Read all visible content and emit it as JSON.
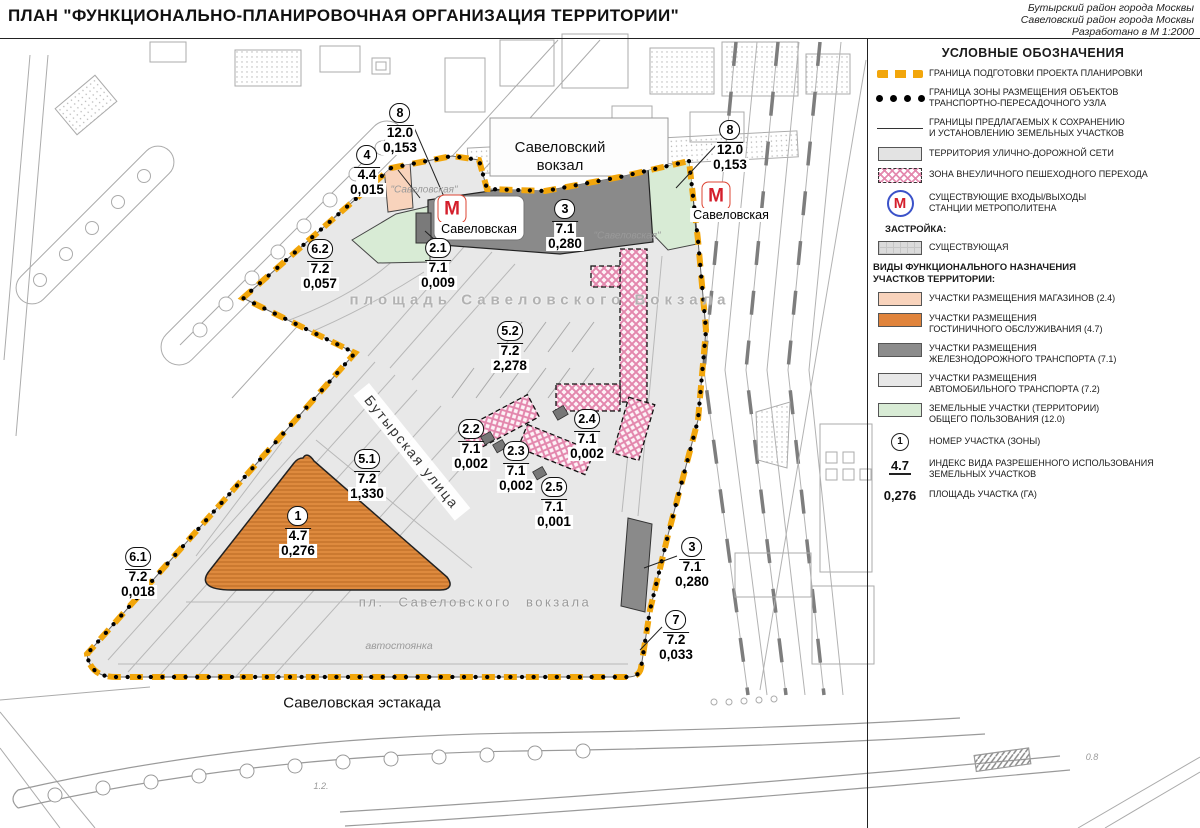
{
  "header": {
    "title": "ПЛАН \"ФУНКЦИОНАЛЬНО-ПЛАНИРОВОЧНАЯ ОРГАНИЗАЦИЯ ТЕРРИТОРИИ\"",
    "corner": "Бутырский район города Москвы\nСавеловский район города Москвы\nРазработано в М 1:2000"
  },
  "legend": {
    "title": "УСЛОВНЫЕ ОБОЗНАЧЕНИЯ",
    "metro_letter": "М",
    "items": {
      "project_boundary": "ГРАНИЦА ПОДГОТОВКИ ПРОЕКТА ПЛАНИРОВКИ",
      "hub_boundary": "ГРАНИЦА ЗОНЫ РАЗМЕЩЕНИЯ ОБЪЕКТОВ\nТРАНСПОРТНО-ПЕРЕСАДОЧНОГО УЗЛА",
      "parcel_boundaries": "ГРАНИЦЫ ПРЕДЛАГАЕМЫХ К СОХРАНЕНИЮ\nИ УСТАНОВЛЕНИЮ ЗЕМЕЛЬНЫХ УЧАСТКОВ",
      "street_network": "ТЕРРИТОРИЯ УЛИЧНО-ДОРОЖНОЙ СЕТИ",
      "pedestrian_zone": "ЗОНА ВНЕУЛИЧНОГО ПЕШЕХОДНОГО ПЕРЕХОДА",
      "metro_entrances": "СУЩЕСТВУЮЩИЕ ВХОДЫ/ВЫХОДЫ\nСТАНЦИИ МЕТРОПОЛИТЕНА"
    },
    "built_title": "ЗАСТРОЙКА:",
    "built_existing": "СУЩЕСТВУЮЩАЯ",
    "functional_title": "ВИДЫ ФУНКЦИОНАЛЬНОГО НАЗНАЧЕНИЯ\nУЧАСТКОВ ТЕРРИТОРИИ:",
    "functional": [
      {
        "color": "#F8D3BC",
        "label": "УЧАСТКИ РАЗМЕЩЕНИЯ МАГАЗИНОВ (2.4)"
      },
      {
        "color": "#E0843C",
        "label": "УЧАСТКИ РАЗМЕЩЕНИЯ\nГОСТИНИЧНОГО ОБСЛУЖИВАНИЯ (4.7)"
      },
      {
        "color": "#8C8C8C",
        "label": "УЧАСТКИ РАЗМЕЩЕНИЯ\nЖЕЛЕЗНОДОРОЖНОГО ТРАНСПОРТА (7.1)"
      },
      {
        "color": "#E8E8E8",
        "label": "УЧАСТКИ РАЗМЕЩЕНИЯ\nАВТОМОБИЛЬНОГО ТРАНСПОРТА (7.2)"
      },
      {
        "color": "#D8EBD5",
        "label": "ЗЕМЕЛЬНЫЕ УЧАСТКИ (ТЕРРИТОРИИ)\nОБЩЕГО ПОЛЬЗОВАНИЯ (12.0)"
      }
    ],
    "notation": {
      "number_symbol": "1",
      "number_label": "НОМЕР УЧАСТКА (ЗОНЫ)",
      "index_symbol": "4.7",
      "index_label": "ИНДЕКС ВИДА РАЗРЕШЕННОГО ИСПОЛЬЗОВАНИЯ\nЗЕМЕЛЬНЫХ УЧАСТКОВ",
      "area_symbol": "0,276",
      "area_label": "ПЛОЩАДЬ УЧАСТКА (ГА)"
    }
  },
  "map": {
    "metro_letter": "М",
    "colors": {
      "boundary_orange": "#F2A60B",
      "shops": "#F8D3BC",
      "hotel": "#DE8A3E",
      "rail": "#8C8C8C",
      "street": "#E8E8E8",
      "public_green": "#D8EBD5",
      "pedestrian_pink": "#E387AD"
    },
    "zones": [
      {
        "num": "8",
        "idx": "12.0",
        "area": "0,153",
        "x": 400,
        "y": 114
      },
      {
        "num": "4",
        "idx": "4.4",
        "area": "0,015",
        "x": 367,
        "y": 156
      },
      {
        "num": "8",
        "idx": "12.0",
        "area": "0,153",
        "x": 730,
        "y": 131
      },
      {
        "num": "6.2",
        "idx": "7.2",
        "area": "0,057",
        "x": 320,
        "y": 250
      },
      {
        "num": "2.1",
        "idx": "7.1",
        "area": "0,009",
        "x": 438,
        "y": 249
      },
      {
        "num": "3",
        "idx": "7.1",
        "area": "0,280",
        "x": 565,
        "y": 210
      },
      {
        "num": "5.2",
        "idx": "7.2",
        "area": "2,278",
        "x": 510,
        "y": 332
      },
      {
        "num": "2.2",
        "idx": "7.1",
        "area": "0,002",
        "x": 471,
        "y": 430
      },
      {
        "num": "2.3",
        "idx": "7.1",
        "area": "0,002",
        "x": 516,
        "y": 452
      },
      {
        "num": "2.4",
        "idx": "7.1",
        "area": "0,002",
        "x": 587,
        "y": 420
      },
      {
        "num": "2.5",
        "idx": "7.1",
        "area": "0,001",
        "x": 554,
        "y": 488
      },
      {
        "num": "5.1",
        "idx": "7.2",
        "area": "1,330",
        "x": 367,
        "y": 460
      },
      {
        "num": "1",
        "idx": "4.7",
        "area": "0,276",
        "x": 298,
        "y": 517
      },
      {
        "num": "6.1",
        "idx": "7.2",
        "area": "0,018",
        "x": 138,
        "y": 558
      },
      {
        "num": "3",
        "idx": "7.1",
        "area": "0,280",
        "x": 692,
        "y": 548
      },
      {
        "num": "7",
        "idx": "7.2",
        "area": "0,033",
        "x": 676,
        "y": 621
      }
    ],
    "labels": [
      {
        "text": "Савеловский\nвокзал",
        "x": 560,
        "y": 157,
        "cls": "lbl-station"
      },
      {
        "text": "\"Савеловская\"",
        "x": 424,
        "y": 190,
        "cls": "lbl-quote"
      },
      {
        "text": "\"Савеловская\"",
        "x": 627,
        "y": 236,
        "cls": "lbl-quote"
      },
      {
        "text": "площадь Савеловского Вокзала",
        "x": 540,
        "y": 300,
        "cls": "lbl-plaza"
      },
      {
        "text": "Бутырская улица",
        "x": 412,
        "y": 452,
        "cls": "lbl-street",
        "rot": 51
      },
      {
        "text": "пл. Савеловского вокзала",
        "x": 475,
        "y": 602,
        "cls": "lbl-plgray"
      },
      {
        "text": "автостоянка",
        "x": 399,
        "y": 646,
        "cls": "lbl-parking"
      },
      {
        "text": "Савеловская эстакада",
        "x": 362,
        "y": 703,
        "cls": "lbl-estakada"
      },
      {
        "text": "1.2.",
        "x": 321,
        "y": 786,
        "cls": "lbl-tiny"
      },
      {
        "text": "0.8",
        "x": 1092,
        "y": 757,
        "cls": "lbl-tiny"
      }
    ],
    "metro": [
      {
        "x": 452,
        "y": 209,
        "label": "Савеловская",
        "lx": 479,
        "ly": 229
      },
      {
        "x": 716,
        "y": 196,
        "label": "Савеловская",
        "lx": 731,
        "ly": 215
      }
    ]
  }
}
